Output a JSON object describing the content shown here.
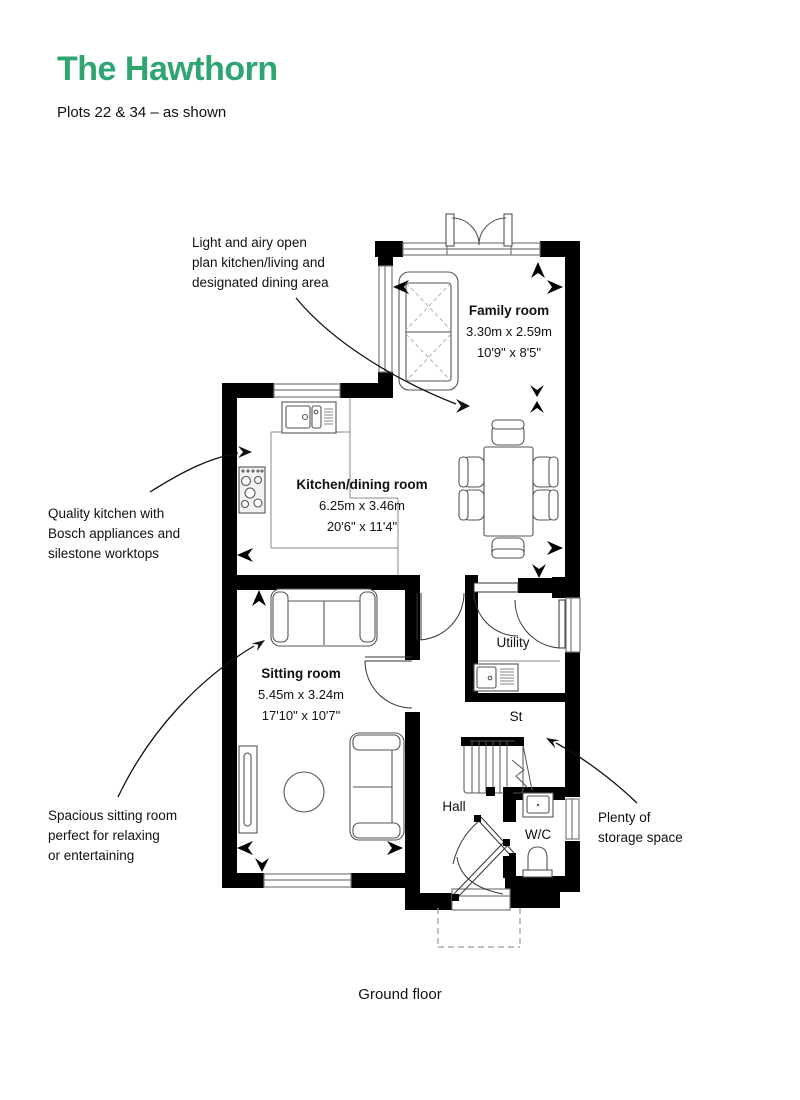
{
  "page": {
    "title": "The Hawthorn",
    "subtitle": "Plots 22 & 34 – as shown",
    "floor_label": "Ground floor"
  },
  "colors": {
    "accent_green": "#2FA571",
    "wall_black": "#000000",
    "fixture_gray": "#5a5a5a",
    "window_gray": "#7a7a7a",
    "text_black": "#111111"
  },
  "rooms": {
    "family": {
      "name": "Family room",
      "metric": "3.30m x 2.59m",
      "imperial": "10'9\" x 8'5\""
    },
    "kitchen": {
      "name": "Kitchen/dining room",
      "metric": "6.25m x 3.46m",
      "imperial": "20'6\" x 11'4\""
    },
    "sitting": {
      "name": "Sitting room",
      "metric": "5.45m x 3.24m",
      "imperial": "17'10\" x 10'7\""
    },
    "utility": {
      "name": "Utility"
    },
    "store": {
      "name": "St"
    },
    "hall": {
      "name": "Hall"
    },
    "wc": {
      "name": "W/C"
    }
  },
  "annotations": {
    "open_plan": "Light and airy open\nplan kitchen/living and\ndesignated dining area",
    "kitchen_quality": "Quality kitchen with\nBosch appliances and\nsilestone worktops",
    "sitting_space": "Spacious sitting room\nperfect for relaxing\nor entertaining",
    "storage": "Plenty of\nstorage space"
  }
}
